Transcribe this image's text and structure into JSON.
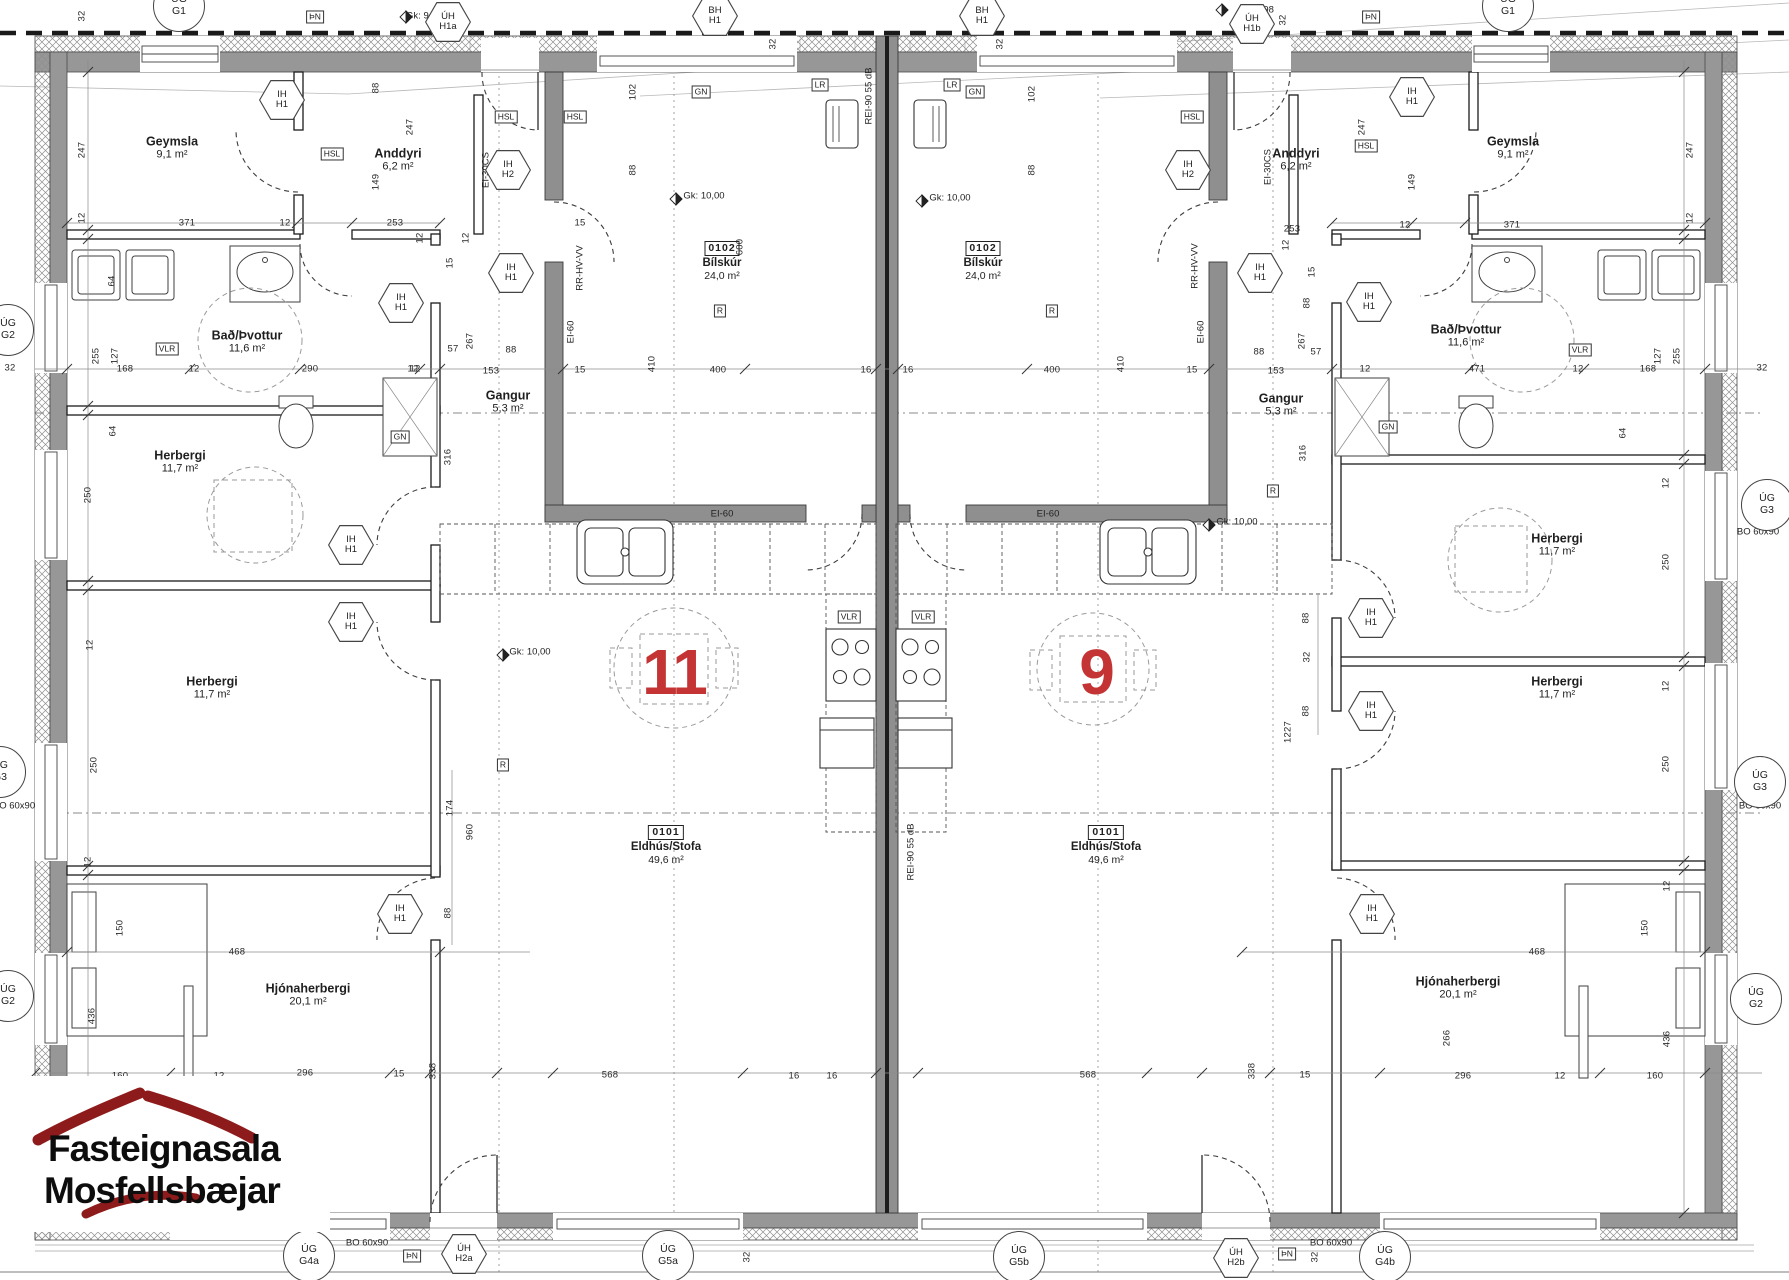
{
  "title": "Grunnmynd - parhús nr. 9 og 11",
  "colors": {
    "accent_red": "#c43434",
    "logo_red": "#8e1b1b",
    "wall_gray": "#979797"
  },
  "logo": {
    "line1": "Fasteignasala",
    "line2": "Mosfellsbæjar"
  },
  "unit_numbers": [
    {
      "n": "11",
      "x": 674,
      "y": 672
    },
    {
      "n": "9",
      "x": 1096,
      "y": 672
    }
  ],
  "rooms": [
    {
      "name": "Geymsla",
      "area": "9,1 m²",
      "x": 172,
      "y": 148
    },
    {
      "name": "Anddyri",
      "area": "6,2 m²",
      "x": 398,
      "y": 160
    },
    {
      "name": "Bað/Þvottur",
      "area": "11,6 m²",
      "x": 247,
      "y": 342
    },
    {
      "name": "Herbergi",
      "area": "11,7 m²",
      "x": 180,
      "y": 462
    },
    {
      "name": "Herbergi",
      "area": "11,7 m²",
      "x": 212,
      "y": 688
    },
    {
      "name": "Hjónaherbergi",
      "area": "20,1 m²",
      "x": 308,
      "y": 995
    },
    {
      "name": "Gangur",
      "area": "5,3 m²",
      "x": 508,
      "y": 402
    },
    {
      "name": "Geymsla",
      "area": "9,1 m²",
      "x": 1513,
      "y": 148
    },
    {
      "name": "Anddyri",
      "area": "6,2 m²",
      "x": 1296,
      "y": 160
    },
    {
      "name": "Bað/Þvottur",
      "area": "11,6 m²",
      "x": 1466,
      "y": 336
    },
    {
      "name": "Herbergi",
      "area": "11,7 m²",
      "x": 1557,
      "y": 545
    },
    {
      "name": "Herbergi",
      "area": "11,7 m²",
      "x": 1557,
      "y": 688
    },
    {
      "name": "Hjónaherbergi",
      "area": "20,1 m²",
      "x": 1458,
      "y": 988
    },
    {
      "name": "Gangur",
      "area": "5,3 m²",
      "x": 1281,
      "y": 405
    }
  ],
  "room_ids": [
    {
      "id": "0102",
      "name": "Bílskúr",
      "area": "24,0 m²",
      "x": 722,
      "y": 262
    },
    {
      "id": "0102",
      "name": "Bílskúr",
      "area": "24,0 m²",
      "x": 983,
      "y": 262
    },
    {
      "id": "0101",
      "name": "Eldhús/Stofa",
      "area": "49,6 m²",
      "x": 666,
      "y": 846
    },
    {
      "id": "0101",
      "name": "Eldhús/Stofa",
      "area": "49,6 m²",
      "x": 1106,
      "y": 846
    }
  ],
  "dims": [
    [
      "32",
      82,
      16,
      1
    ],
    [
      "247",
      82,
      150,
      1
    ],
    [
      "12",
      82,
      218,
      1
    ],
    [
      "371",
      187,
      223,
      0
    ],
    [
      "12",
      285,
      223,
      0
    ],
    [
      "253",
      395,
      223,
      0
    ],
    [
      "88",
      376,
      88,
      1
    ],
    [
      "149",
      376,
      182,
      1
    ],
    [
      "247",
      410,
      127,
      1
    ],
    [
      "12",
      420,
      238,
      1
    ],
    [
      "15",
      580,
      223,
      0
    ],
    [
      "102",
      633,
      92,
      1
    ],
    [
      "88",
      633,
      170,
      1
    ],
    [
      "32",
      773,
      44,
      1
    ],
    [
      "600",
      740,
      247,
      1
    ],
    [
      "15",
      450,
      263,
      1
    ],
    [
      "12",
      466,
      238,
      1
    ],
    [
      "267",
      470,
      341,
      1
    ],
    [
      "57",
      453,
      349,
      0
    ],
    [
      "88",
      511,
      350,
      0
    ],
    [
      "12",
      413,
      369,
      0
    ],
    [
      "153",
      491,
      371,
      0
    ],
    [
      "15",
      580,
      370,
      0
    ],
    [
      "410",
      652,
      364,
      1
    ],
    [
      "400",
      718,
      370,
      0
    ],
    [
      "16",
      866,
      370,
      0
    ],
    [
      "16",
      908,
      370,
      0
    ],
    [
      "400",
      1052,
      370,
      0
    ],
    [
      "410",
      1121,
      364,
      1
    ],
    [
      "15",
      1192,
      370,
      0
    ],
    [
      "153",
      1276,
      371,
      0
    ],
    [
      "12",
      1365,
      369,
      0
    ],
    [
      "57",
      1316,
      352,
      0
    ],
    [
      "88",
      1259,
      352,
      0
    ],
    [
      "12",
      1286,
      245,
      1
    ],
    [
      "15",
      1312,
      272,
      1
    ],
    [
      "88",
      1307,
      303,
      1
    ],
    [
      "267",
      1302,
      341,
      1
    ],
    [
      "32",
      1000,
      44,
      1
    ],
    [
      "102",
      1032,
      94,
      1
    ],
    [
      "88",
      1032,
      170,
      1
    ],
    [
      "149",
      1412,
      182,
      1
    ],
    [
      "247",
      1362,
      127,
      1
    ],
    [
      "247",
      1690,
      150,
      1
    ],
    [
      "12",
      1690,
      218,
      1
    ],
    [
      "253",
      1292,
      229,
      0
    ],
    [
      "12",
      1405,
      225,
      0
    ],
    [
      "371",
      1512,
      225,
      0
    ],
    [
      "32",
      1283,
      20,
      1
    ],
    [
      "32",
      462,
      20,
      1
    ],
    [
      "64",
      112,
      281,
      1
    ],
    [
      "255",
      96,
      356,
      1
    ],
    [
      "127",
      115,
      356,
      1
    ],
    [
      "168",
      125,
      369,
      0
    ],
    [
      "12",
      194,
      369,
      0
    ],
    [
      "290",
      310,
      369,
      0
    ],
    [
      "12",
      415,
      369,
      0
    ],
    [
      "32",
      10,
      368,
      0
    ],
    [
      "64",
      113,
      431,
      1
    ],
    [
      "471",
      1477,
      369,
      0
    ],
    [
      "64",
      1623,
      433,
      1
    ],
    [
      "255",
      1677,
      356,
      1
    ],
    [
      "127",
      1658,
      356,
      1
    ],
    [
      "168",
      1648,
      369,
      0
    ],
    [
      "12",
      1578,
      369,
      0
    ],
    [
      "32",
      1762,
      368,
      0
    ],
    [
      "250",
      88,
      495,
      1
    ],
    [
      "12",
      90,
      645,
      1
    ],
    [
      "250",
      94,
      765,
      1
    ],
    [
      "12",
      88,
      862,
      1
    ],
    [
      "436",
      92,
      1016,
      1
    ],
    [
      "150",
      120,
      928,
      1
    ],
    [
      "160",
      120,
      1076,
      0
    ],
    [
      "12",
      219,
      1076,
      0
    ],
    [
      "296",
      305,
      1073,
      0
    ],
    [
      "15",
      399,
      1074,
      0
    ],
    [
      "468",
      237,
      952,
      0
    ],
    [
      "338",
      433,
      1071,
      1
    ],
    [
      "568",
      610,
      1075,
      0
    ],
    [
      "16",
      794,
      1076,
      0
    ],
    [
      "16",
      832,
      1076,
      0
    ],
    [
      "32",
      747,
      1257,
      1
    ],
    [
      "960",
      470,
      832,
      1
    ],
    [
      "174",
      450,
      808,
      1
    ],
    [
      "88",
      448,
      913,
      1
    ],
    [
      "316",
      448,
      457,
      1
    ],
    [
      "12",
      1666,
      483,
      1
    ],
    [
      "250",
      1666,
      562,
      1
    ],
    [
      "12",
      1666,
      686,
      1
    ],
    [
      "250",
      1666,
      764,
      1
    ],
    [
      "12",
      1667,
      886,
      1
    ],
    [
      "436",
      1667,
      1039,
      1
    ],
    [
      "150",
      1645,
      928,
      1
    ],
    [
      "160",
      1655,
      1076,
      0
    ],
    [
      "12",
      1560,
      1076,
      0
    ],
    [
      "296",
      1463,
      1076,
      0
    ],
    [
      "15",
      1305,
      1075,
      0
    ],
    [
      "468",
      1537,
      952,
      0
    ],
    [
      "338",
      1252,
      1071,
      1
    ],
    [
      "568",
      1088,
      1075,
      0
    ],
    [
      "32",
      1315,
      1257,
      1
    ],
    [
      "1227",
      1288,
      732,
      1
    ],
    [
      "88",
      1306,
      618,
      1
    ],
    [
      "32",
      1307,
      657,
      1
    ],
    [
      "88",
      1306,
      711,
      1
    ],
    [
      "316",
      1303,
      453,
      1
    ],
    [
      "266",
      1447,
      1038,
      1
    ]
  ],
  "texts": [
    {
      "t": "Gk: 9,98",
      "x": 424,
      "y": 16,
      "r": 0
    },
    {
      "t": "Gk: 9,98",
      "x": 1256,
      "y": 10,
      "r": 0
    },
    {
      "t": "Gk: 10,00",
      "x": 704,
      "y": 196,
      "r": 0
    },
    {
      "t": "Gk: 10,00",
      "x": 530,
      "y": 652,
      "r": 0
    },
    {
      "t": "Gk: 10,00",
      "x": 950,
      "y": 198,
      "r": 0
    },
    {
      "t": "Gk: 10,00",
      "x": 1237,
      "y": 522,
      "r": 0
    },
    {
      "t": "BO 60x90",
      "x": 367,
      "y": 1243,
      "r": 0
    },
    {
      "t": "BO 60x90",
      "x": 1331,
      "y": 1243,
      "r": 0
    },
    {
      "t": "BO 60x90",
      "x": 1758,
      "y": 532,
      "r": 0
    },
    {
      "t": "BO 60x90",
      "x": 1760,
      "y": 806,
      "r": 0
    },
    {
      "t": "BO 60x90",
      "x": 14,
      "y": 806,
      "r": 0
    },
    {
      "t": "EI-60",
      "x": 571,
      "y": 332,
      "r": 1
    },
    {
      "t": "EI-60",
      "x": 1201,
      "y": 332,
      "r": 1
    },
    {
      "t": "EI-60",
      "x": 722,
      "y": 514,
      "r": 0
    },
    {
      "t": "EI-60",
      "x": 1048,
      "y": 514,
      "r": 0
    },
    {
      "t": "RR-HV-VV",
      "x": 580,
      "y": 268,
      "r": 1
    },
    {
      "t": "RR-HV-VV",
      "x": 1195,
      "y": 266,
      "r": 1
    },
    {
      "t": "EI-30CS",
      "x": 486,
      "y": 170,
      "r": 1
    },
    {
      "t": "EI-30CS",
      "x": 1268,
      "y": 167,
      "r": 1
    },
    {
      "t": "REI-90 55 dB",
      "x": 911,
      "y": 852,
      "r": 1
    },
    {
      "t": "REI-90 55 dB",
      "x": 869,
      "y": 96,
      "r": 1
    }
  ],
  "tags": {
    "hex": [
      {
        "t1": "IH",
        "t2": "H1",
        "x": 282,
        "y": 100
      },
      {
        "t1": "IH",
        "t2": "H2",
        "x": 508,
        "y": 170
      },
      {
        "t1": "IH",
        "t2": "H1",
        "x": 511,
        "y": 273
      },
      {
        "t1": "IH",
        "t2": "H1",
        "x": 401,
        "y": 303
      },
      {
        "t1": "IH",
        "t2": "H1",
        "x": 351,
        "y": 545
      },
      {
        "t1": "IH",
        "t2": "H1",
        "x": 351,
        "y": 622
      },
      {
        "t1": "IH",
        "t2": "H1",
        "x": 400,
        "y": 914
      },
      {
        "t1": "IH",
        "t2": "H1",
        "x": 1412,
        "y": 97
      },
      {
        "t1": "IH",
        "t2": "H2",
        "x": 1188,
        "y": 170
      },
      {
        "t1": "IH",
        "t2": "H1",
        "x": 1260,
        "y": 273
      },
      {
        "t1": "IH",
        "t2": "H1",
        "x": 1369,
        "y": 302
      },
      {
        "t1": "IH",
        "t2": "H1",
        "x": 1371,
        "y": 618
      },
      {
        "t1": "IH",
        "t2": "H1",
        "x": 1371,
        "y": 711
      },
      {
        "t1": "IH",
        "t2": "H1",
        "x": 1372,
        "y": 914
      },
      {
        "t1": "BH",
        "t2": "H1",
        "x": 715,
        "y": 16
      },
      {
        "t1": "BH",
        "t2": "H1",
        "x": 982,
        "y": 16
      },
      {
        "t1": "ÚH",
        "t2": "H1a",
        "x": 448,
        "y": 22
      },
      {
        "t1": "ÚH",
        "t2": "H1b",
        "x": 1252,
        "y": 24
      },
      {
        "t1": "ÚH",
        "t2": "H2a",
        "x": 464,
        "y": 1254
      },
      {
        "t1": "ÚH",
        "t2": "H2b",
        "x": 1236,
        "y": 1258
      }
    ],
    "circle": [
      {
        "t1": "ÚG",
        "t2": "G1",
        "x": 179,
        "y": 6
      },
      {
        "t1": "ÚG",
        "t2": "G1",
        "x": 1508,
        "y": 6
      },
      {
        "t1": "ÚG",
        "t2": "G2",
        "x": 8,
        "y": 330
      },
      {
        "t1": "ÚG",
        "t2": "G3",
        "x": 0,
        "y": 772
      },
      {
        "t1": "ÚG",
        "t2": "G2",
        "x": 8,
        "y": 996
      },
      {
        "t1": "ÚG",
        "t2": "G3",
        "x": 1767,
        "y": 505
      },
      {
        "t1": "ÚG",
        "t2": "G3",
        "x": 1760,
        "y": 782
      },
      {
        "t1": "ÚG",
        "t2": "G2",
        "x": 1756,
        "y": 999
      },
      {
        "t1": "ÚG",
        "t2": "G4a",
        "x": 309,
        "y": 1256
      },
      {
        "t1": "ÚG",
        "t2": "G5a",
        "x": 668,
        "y": 1256
      },
      {
        "t1": "ÚG",
        "t2": "G5b",
        "x": 1019,
        "y": 1257
      },
      {
        "t1": "ÚG",
        "t2": "G4b",
        "x": 1385,
        "y": 1257
      }
    ],
    "box": [
      {
        "t": "ÞN",
        "x": 315,
        "y": 17
      },
      {
        "t": "ÞN",
        "x": 1371,
        "y": 17
      },
      {
        "t": "ÞN",
        "x": 412,
        "y": 1256
      },
      {
        "t": "ÞN",
        "x": 1287,
        "y": 1254
      },
      {
        "t": "HSL",
        "x": 332,
        "y": 154
      },
      {
        "t": "HSL",
        "x": 506,
        "y": 117
      },
      {
        "t": "HSL",
        "x": 575,
        "y": 117
      },
      {
        "t": "HSL",
        "x": 1192,
        "y": 117
      },
      {
        "t": "HSL",
        "x": 1366,
        "y": 146
      },
      {
        "t": "LR",
        "x": 820,
        "y": 85
      },
      {
        "t": "LR",
        "x": 952,
        "y": 85
      },
      {
        "t": "GN",
        "x": 701,
        "y": 92
      },
      {
        "t": "GN",
        "x": 975,
        "y": 92
      },
      {
        "t": "GN",
        "x": 400,
        "y": 437
      },
      {
        "t": "GN",
        "x": 1388,
        "y": 427
      },
      {
        "t": "VLR",
        "x": 167,
        "y": 349
      },
      {
        "t": "VLR",
        "x": 1580,
        "y": 350
      },
      {
        "t": "VLR",
        "x": 849,
        "y": 617
      },
      {
        "t": "VLR",
        "x": 923,
        "y": 617
      },
      {
        "t": "R",
        "x": 720,
        "y": 311
      },
      {
        "t": "R",
        "x": 1052,
        "y": 311
      },
      {
        "t": "R",
        "x": 503,
        "y": 765
      },
      {
        "t": "R",
        "x": 1273,
        "y": 491
      }
    ]
  }
}
